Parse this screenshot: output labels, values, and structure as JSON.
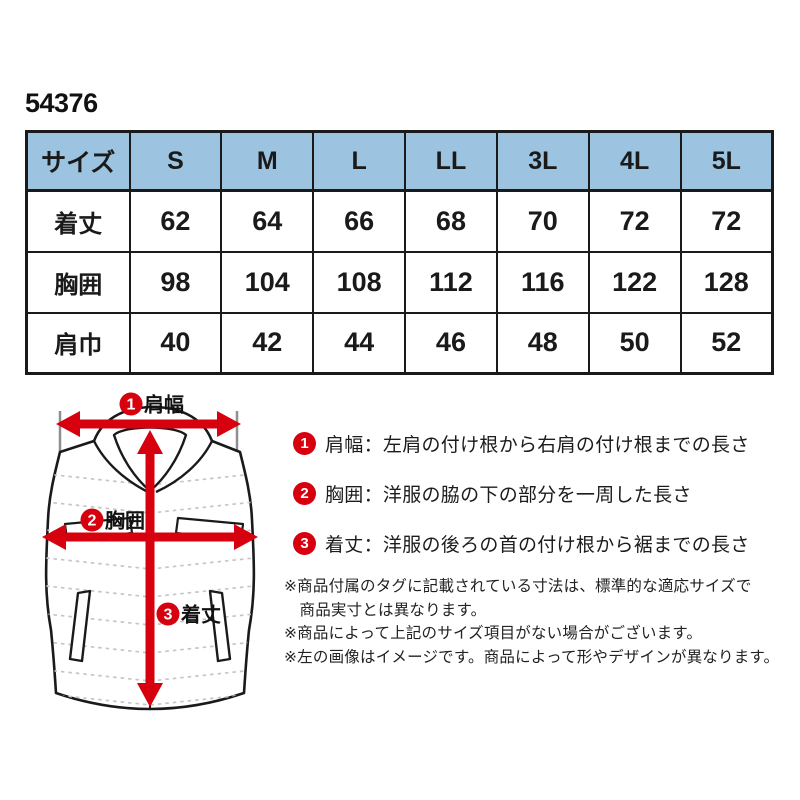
{
  "product": {
    "code": "54376"
  },
  "colors": {
    "accent_red": "#d7000f",
    "table_header_blue": "#9cc3e0",
    "outline_black": "#1a1a1a",
    "quilt_gray": "#c6c6c6"
  },
  "size_table": {
    "header": [
      "サイズ",
      "S",
      "M",
      "L",
      "LL",
      "3L",
      "4L",
      "5L"
    ],
    "rows": [
      {
        "label": "着丈",
        "values": [
          "62",
          "64",
          "66",
          "68",
          "70",
          "72",
          "72"
        ]
      },
      {
        "label": "胸囲",
        "values": [
          "98",
          "104",
          "108",
          "112",
          "116",
          "122",
          "128"
        ]
      },
      {
        "label": "肩巾",
        "values": [
          "40",
          "42",
          "44",
          "46",
          "48",
          "50",
          "52"
        ]
      }
    ]
  },
  "diagram": {
    "badge1": {
      "num": "1",
      "label": "肩幅"
    },
    "badge2": {
      "num": "2",
      "label": "胸囲"
    },
    "badge3": {
      "num": "3",
      "label": "着丈"
    }
  },
  "legend": {
    "items": [
      {
        "num": "1",
        "text": "肩幅：左肩の付け根から右肩の付け根までの長さ"
      },
      {
        "num": "2",
        "text": "胸囲：洋服の脇の下の部分を一周した長さ"
      },
      {
        "num": "3",
        "text": "着丈：洋服の後ろの首の付け根から裾までの長さ"
      }
    ]
  },
  "notes": {
    "items": [
      "※商品付属のタグに記載されている寸法は、標準的な適応サイズで\n商品実寸とは異なります。",
      "※商品によって上記のサイズ項目がない場合がございます。",
      "※左の画像はイメージです。商品によって形やデザインが異なります。"
    ]
  }
}
